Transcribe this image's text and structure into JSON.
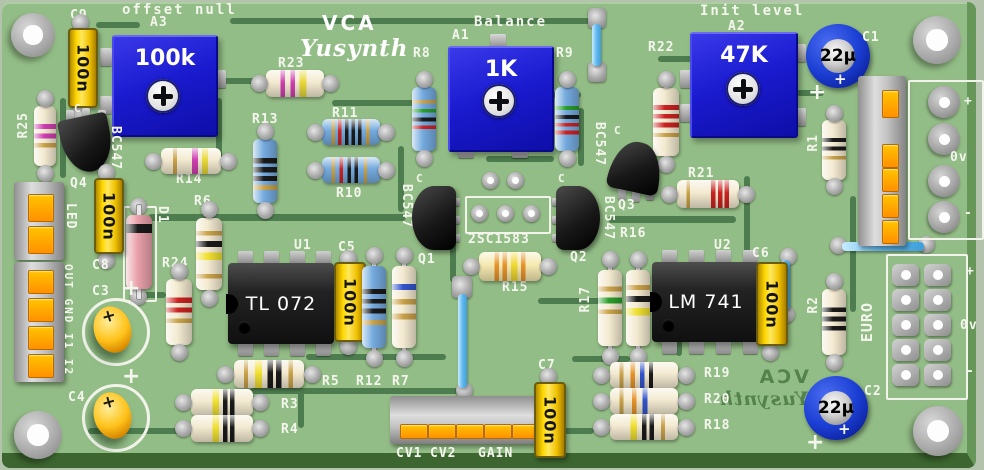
{
  "colors": {
    "board_green": "#93bd86",
    "trace_green": "#4d7c4f",
    "edge_green": "#3c652f",
    "silkscreen": "#f4f6ee",
    "trimmer_blue": "#1b1bd0",
    "cap_yellow": "#ffd800",
    "electrolytic_blue": "#1b3fd4",
    "jumper_blue": "#62b8ef"
  },
  "silkscreen": {
    "offset_null": "offset null",
    "balance": "Balance",
    "init_level": "Init level",
    "logo_title": "VCA",
    "logo_brand": "Yusynth",
    "footprint": "2SC1583",
    "collector_mark": "C"
  },
  "polarity_mark": "+",
  "trimmers": [
    {
      "id": "A3",
      "value": "100k"
    },
    {
      "id": "A1",
      "value": "1K"
    },
    {
      "id": "A2",
      "value": "47K"
    }
  ],
  "ics": [
    {
      "id": "U1",
      "part": "TL 072"
    },
    {
      "id": "U2",
      "part": "LM 741"
    }
  ],
  "transistors": [
    {
      "id": "Q1",
      "part": "BC547"
    },
    {
      "id": "Q2",
      "part": "BC547"
    },
    {
      "id": "Q3",
      "part": "BC547"
    },
    {
      "id": "Q4",
      "part": "BC547"
    }
  ],
  "resistors": [
    "R1",
    "R2",
    "R3",
    "R4",
    "R5",
    "R6",
    "R7",
    "R8",
    "R9",
    "R10",
    "R11",
    "R12",
    "R13",
    "R14",
    "R15",
    "R16",
    "R17",
    "R18",
    "R19",
    "R20",
    "R21",
    "R22",
    "R23",
    "R24",
    "R25"
  ],
  "capacitors": {
    "c1": {
      "id": "C1",
      "value": "22µ"
    },
    "c2": {
      "id": "C2",
      "value": "22µ"
    },
    "c3": {
      "id": "C3"
    },
    "c4": {
      "id": "C4"
    },
    "c5": {
      "id": "C5",
      "value": "100n"
    },
    "c6": {
      "id": "C6",
      "value": "100n"
    },
    "c7": {
      "id": "C7",
      "value": "100n"
    },
    "c8": {
      "id": "C8",
      "value": "100n"
    },
    "c9": {
      "id": "C9",
      "value": "100n"
    }
  },
  "diode": {
    "id": "D1"
  },
  "connectors": {
    "led": {
      "label": "LED"
    },
    "io": {
      "label": "OUT GND I1 I2"
    },
    "cv": {
      "labels": [
        "CV1",
        "CV2",
        "GAIN"
      ]
    },
    "power": {
      "plus": "+",
      "zero": "0v",
      "minus": "-"
    },
    "euro": {
      "label": "EURO",
      "plus": "+",
      "zero": "0v",
      "minus": "-"
    }
  }
}
